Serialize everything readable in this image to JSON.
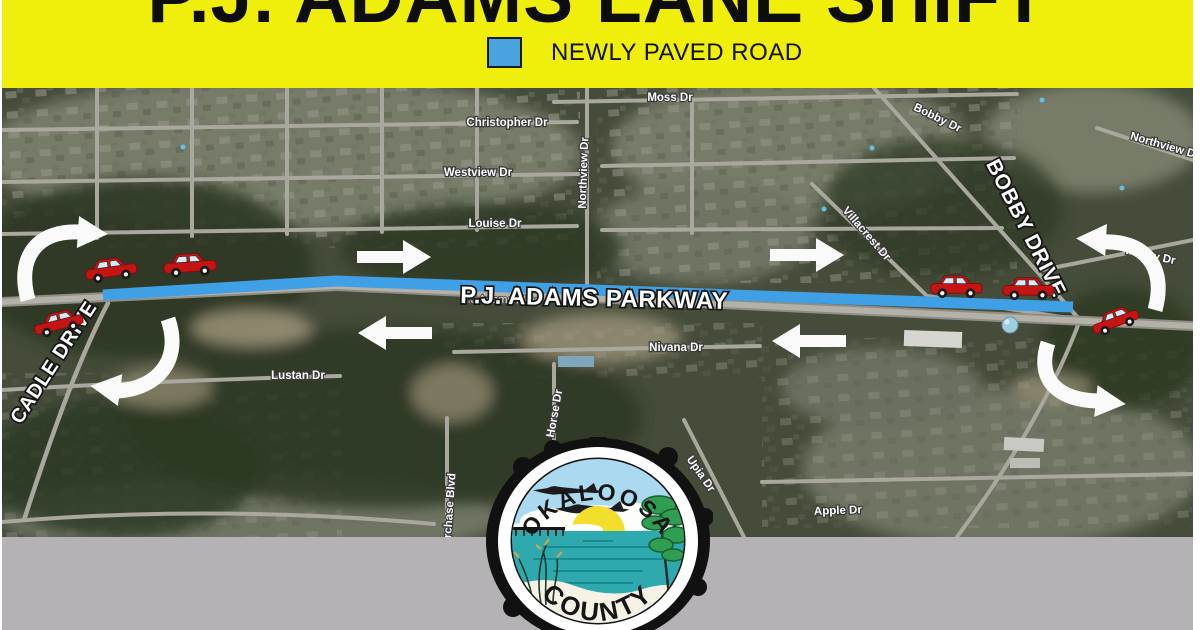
{
  "banner": {
    "title": "P.J. ADAMS LANE SHIFT",
    "legend_label": "NEWLY PAVED ROAD"
  },
  "map": {
    "parkway_label": "P.J. ADAMS PARKWAY",
    "parkway_small_label": "P.J Adams Pkwy",
    "cadle_label": "CADLE DRIVE",
    "bobby_label": "BOBBY DRIVE",
    "street_labels": [
      "Moss Dr",
      "Christopher Dr",
      "Westview Dr",
      "Louise Dr",
      "Northview Dr",
      "Bobby Dr",
      "Northview Dr",
      "Villacrest Dr",
      "Peggy Dr",
      "Lustan Dr",
      "Nivana Dr",
      "Horse Dr",
      "erchase Blvd",
      "Upia Dr",
      "Apple Dr"
    ]
  },
  "seal": {
    "top_text": "OKALOOSA",
    "bottom_text": "COUNTY"
  },
  "colors": {
    "banner_yellow": "#F0EE0B",
    "paved_blue": "#3FA0E6",
    "footer_gray": "#B4B2B5",
    "car_red": "#C41414",
    "arrow_white": "#FAFAFA"
  }
}
